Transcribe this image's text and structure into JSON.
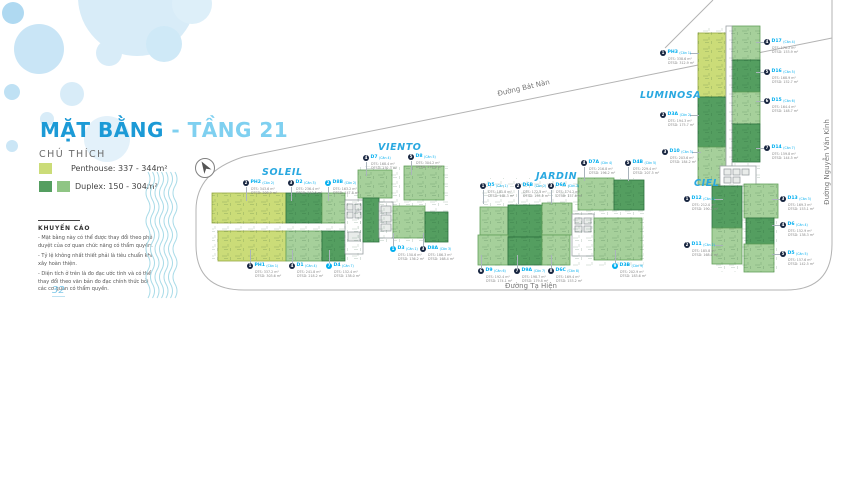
{
  "title": {
    "main": "MẶT BẰNG",
    "sub": "- TẦNG 21"
  },
  "legend": {
    "heading": "CHÚ THÍCH",
    "items": [
      {
        "label": "Penthouse: 337 - 344m²",
        "colors": [
          "#CBDC78"
        ]
      },
      {
        "label": "Duplex: 150 - 304m²",
        "colors": [
          "#549E60",
          "#8FC584"
        ]
      }
    ]
  },
  "disclaimer": {
    "heading": "KHUYẾN CÁO",
    "lines": [
      "- Mặt bằng này có thể được thay đổi theo phê duyệt của cơ quan chức năng có thẩm quyền.",
      "- Tỷ lệ không nhất thiết phải là tiêu chuẩn khi xây hoàn thiện.",
      "- Diện tích ở trên là đo đạc ước tính và có thể thay đổi theo văn bản đo đạc chính thức bởi các cơ quan có thẩm quyền."
    ]
  },
  "streets": {
    "top": "Đường Bát Nàn",
    "bottom": "Đường Tạ Hiện",
    "right": "Đường Nguyễn Văn Kỉnh"
  },
  "page_number": "32",
  "colors": {
    "title_blue": "#1C9AD6",
    "title_light_blue": "#7FD0F0",
    "accent_blue": "#29A8E0",
    "label_cyan": "#00AEEF",
    "penthouse": "#CBDC78",
    "duplex_dark": "#549E60",
    "duplex_light": "#A6D09B"
  },
  "towers": {
    "soleil": {
      "name": "SOLEIL",
      "units": [
        {
          "num": "2",
          "code": "PH2",
          "variant": "(Căn 2)",
          "dt": "DTS: 343.6 m²",
          "dtsd": "DTSD: 308.9 m²"
        },
        {
          "num": "3",
          "code": "D2",
          "variant": "(Căn 3)",
          "dt": "DTS: 236.4 m²",
          "dtsd": "DTSD: 213.5 m²"
        },
        {
          "num": "1",
          "code": "PH1",
          "variant": "(Căn 1)",
          "dt": "DTS: 337.2 m²",
          "dtsd": "DTSD: 303.6 m²"
        },
        {
          "num": "4",
          "code": "D1",
          "variant": "(Căn 4)",
          "dt": "DTS: 241.8 m²",
          "dtsd": "DTSD: 218.2 m²"
        },
        {
          "num": "7",
          "code": "D4",
          "variant": "(Căn 7)",
          "dt": "DTS: 152.4 m²",
          "dtsd": "DTSD: 138.0 m²"
        }
      ]
    },
    "viento": {
      "name": "VIENTO",
      "units": [
        {
          "num": "2",
          "code": "D8B",
          "variant": "(Căn 2)",
          "dt": "DTS: 163.2 m²",
          "dtsd": "DTSD: 147.8 m²"
        },
        {
          "num": "4",
          "code": "D7",
          "variant": "(Căn 4)",
          "dt": "DTS: 168.4 m²",
          "dtsd": "DTSD: 152.3 m²"
        },
        {
          "num": "5",
          "code": "D8",
          "variant": "(Căn 5)",
          "dt": "DTS: 304.2 m²",
          "dtsd": "DTSD: 274.6 m²"
        },
        {
          "num": "1",
          "code": "D3",
          "variant": "(Căn 1)",
          "dt": "DTS: 150.6 m²",
          "dtsd": "DTSD: 136.2 m²"
        },
        {
          "num": "3",
          "code": "D8A",
          "variant": "(Căn 3)",
          "dt": "DTS: 186.3 m²",
          "dtsd": "DTSD: 168.4 m²"
        }
      ]
    },
    "jardin": {
      "name": "JARDIN",
      "units": [
        {
          "num": "1",
          "code": "D5",
          "variant": "(Căn 1)",
          "dt": "DTS: 181.8 m²",
          "dtsd": "DTSD: 164.3 m²"
        },
        {
          "num": "2",
          "code": "D6B",
          "variant": "(Căn 2)",
          "dt": "DTS: 172.5 m²",
          "dtsd": "DTSD: 155.9 m²"
        },
        {
          "num": "3",
          "code": "D6A",
          "variant": "(Căn 3)",
          "dt": "DTS: 174.2 m²",
          "dtsd": "DTSD: 157.6 m²"
        },
        {
          "num": "4",
          "code": "D7A",
          "variant": "(Căn 4)",
          "dt": "DTS: 216.8 m²",
          "dtsd": "DTSD: 196.2 m²"
        },
        {
          "num": "5",
          "code": "D4B",
          "variant": "(Căn 5)",
          "dt": "DTS: 229.4 m²",
          "dtsd": "DTSD: 207.5 m²"
        },
        {
          "num": "6",
          "code": "D9",
          "variant": "(Căn 6)",
          "dt": "DTS: 192.4 m²",
          "dtsd": "DTSD: 174.1 m²"
        },
        {
          "num": "7",
          "code": "D9A",
          "variant": "(Căn 7)",
          "dt": "DTS: 198.7 m²",
          "dtsd": "DTSD: 179.8 m²"
        },
        {
          "num": "8",
          "code": "D6C",
          "variant": "(Căn 8)",
          "dt": "DTS: 169.4 m²",
          "dtsd": "DTSD: 153.2 m²"
        },
        {
          "num": "9",
          "code": "D3B",
          "variant": "(Căn 9)",
          "dt": "DTS: 202.9 m²",
          "dtsd": "DTSD: 183.6 m²"
        }
      ]
    },
    "luminosa": {
      "name": "LUMINOSA",
      "units": [
        {
          "num": "1",
          "code": "PH3",
          "variant": "(Căn 1)",
          "dt": "DTS: 338.6 m²",
          "dtsd": "DTSD: 312.9 m²"
        },
        {
          "num": "2",
          "code": "D3A",
          "variant": "(Căn 2)",
          "dt": "DTS: 194.3 m²",
          "dtsd": "DTSD: 175.7 m²"
        },
        {
          "num": "3",
          "code": "D10",
          "variant": "(Căn 3)",
          "dt": "DTS: 203.6 m²",
          "dtsd": "DTSD: 184.2 m²"
        },
        {
          "num": "4",
          "code": "D17",
          "variant": "(Căn 4)",
          "dt": "DTS: 170.2 m²",
          "dtsd": "DTSD: 153.9 m²"
        },
        {
          "num": "5",
          "code": "D16",
          "variant": "(Căn 5)",
          "dt": "DTS: 168.9 m²",
          "dtsd": "DTSD: 152.7 m²"
        },
        {
          "num": "6",
          "code": "D15",
          "variant": "(Căn 6)",
          "dt": "DTS: 164.4 m²",
          "dtsd": "DTSD: 148.7 m²"
        },
        {
          "num": "7",
          "code": "D14",
          "variant": "(Căn 7)",
          "dt": "DTS: 159.8 m²",
          "dtsd": "DTSD: 144.5 m²"
        }
      ]
    },
    "ciel": {
      "name": "CIEL",
      "units": [
        {
          "num": "1",
          "code": "D12",
          "variant": "(Căn 1)",
          "dt": "DTS: 212.0 m²",
          "dtsd": "DTSD: 190.3 m²"
        },
        {
          "num": "2",
          "code": "D11",
          "variant": "(Căn 2)",
          "dt": "DTS: 185.8 m²",
          "dtsd": "DTSD: 168.0 m²"
        },
        {
          "num": "3",
          "code": "D13",
          "variant": "(Căn 3)",
          "dt": "DTS: 169.3 m²",
          "dtsd": "DTSD: 153.1 m²"
        },
        {
          "num": "4",
          "code": "D6",
          "variant": "(Căn 4)",
          "dt": "DTS: 152.9 m²",
          "dtsd": "DTSD: 138.3 m²"
        },
        {
          "num": "5",
          "code": "D5",
          "variant": "(Căn 5)",
          "dt": "DTS: 157.6 m²",
          "dtsd": "DTSD: 142.5 m²"
        }
      ]
    }
  },
  "icons": {
    "compass": "north-arrow-icon",
    "waves": "river-waves-icon"
  }
}
